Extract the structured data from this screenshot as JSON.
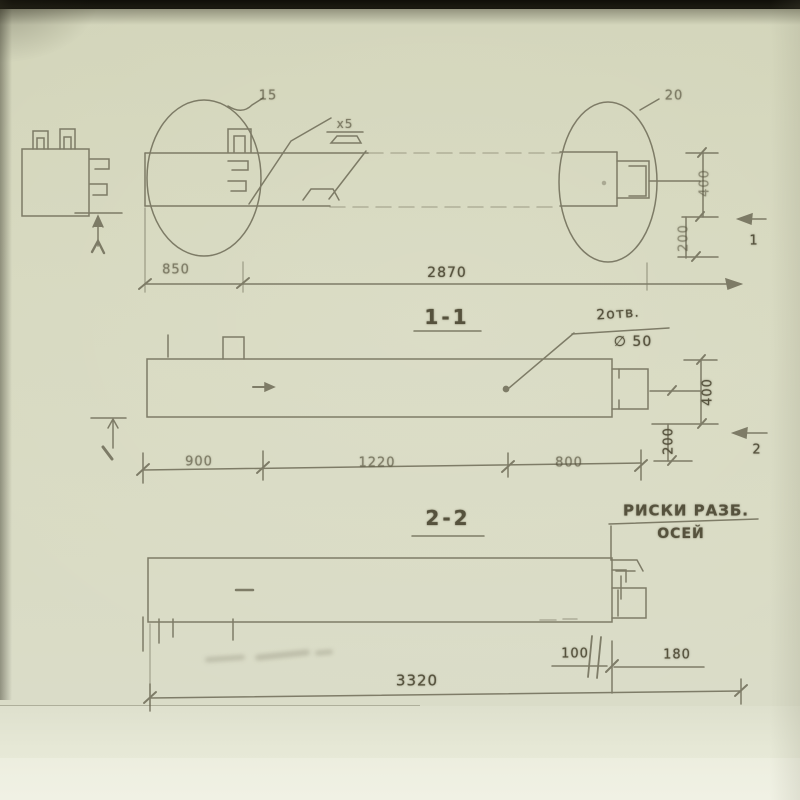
{
  "elevation": {
    "balloon_left": "15",
    "balloon_right": "20",
    "weld_note": "х5",
    "dim_left": "850",
    "dim_right": "2870",
    "dim_depth_upper": "400",
    "dim_depth_lower": "200",
    "cut_mark": "1"
  },
  "section11": {
    "title": "1-1",
    "hole_note_top": "2отв.",
    "hole_note_bottom": "∅ 50",
    "dim_seg1": "900",
    "dim_seg2": "1220",
    "dim_seg3": "800",
    "dim_depth_upper": "400",
    "dim_depth_lower": "200",
    "cut_mark": "2"
  },
  "section22": {
    "title": "2-2",
    "axis_note_top": "РИСКИ РАЗБ.",
    "axis_note_bottom": "ОСЕЙ",
    "dim_offset": "100",
    "dim_end": "180",
    "dim_total": "3320"
  },
  "colors": {
    "paper": "#d7d9c0",
    "ink": "#5f5c49",
    "top_band": "#15140d"
  }
}
